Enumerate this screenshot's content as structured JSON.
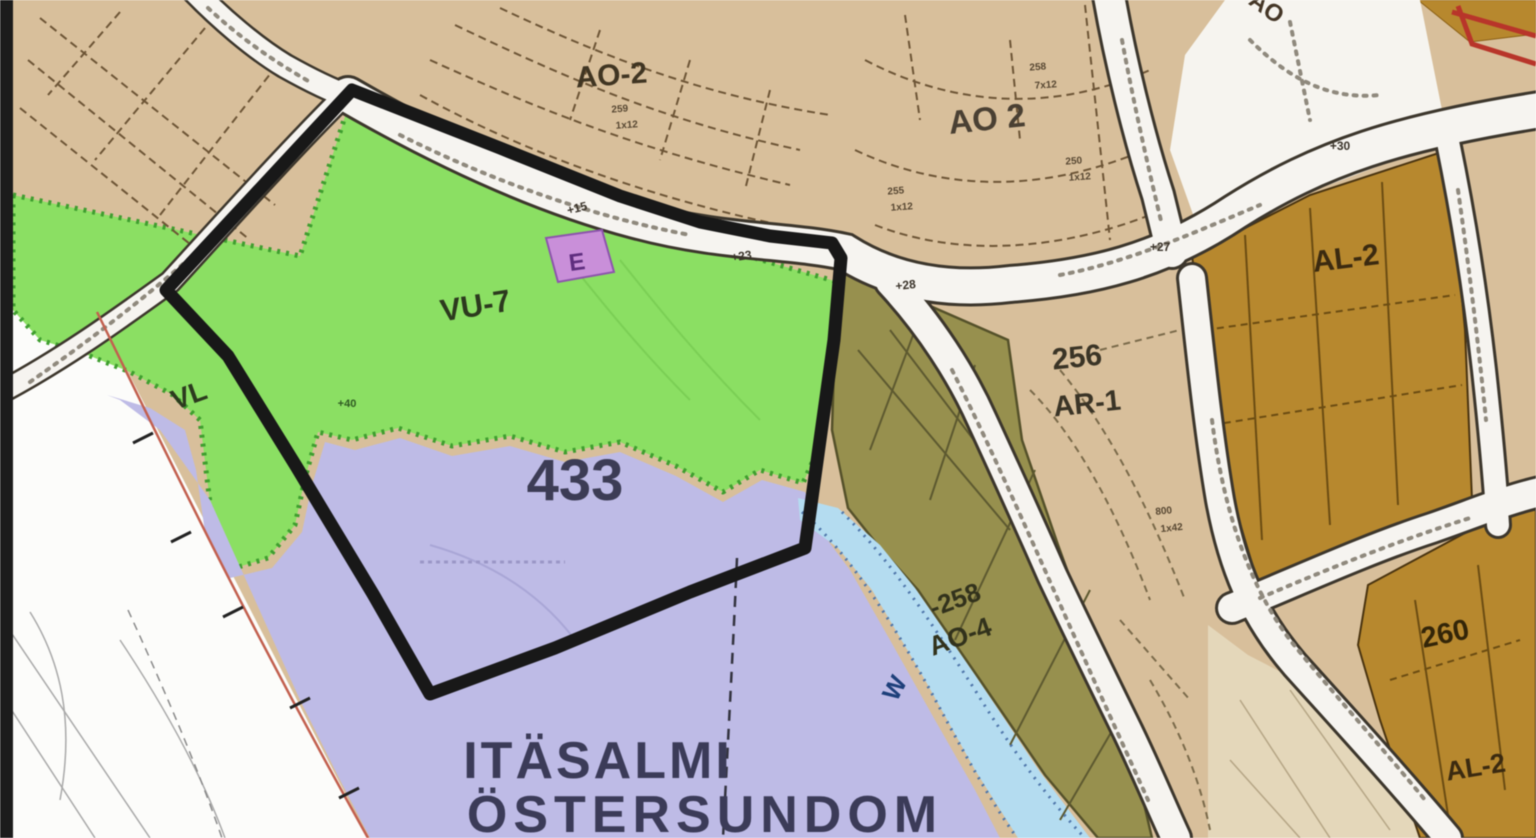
{
  "map": {
    "description_labels": {
      "ao2_west": "AO-2",
      "ao2_east": "AO 2",
      "vu7": "VU-7",
      "vl": "VL",
      "district_number": "433",
      "b256": "256",
      "ar1": "AR-1",
      "b258": "-258",
      "ao4": "AO-4",
      "al2_north": "AL-2",
      "b260": "260",
      "al2_south": "AL-2",
      "water": "W",
      "et": "E",
      "ao_partial": "AO"
    },
    "place": {
      "line1": "ITÄSALMI",
      "line2": "ÖSTERSUNDOM"
    },
    "elevations": [
      "+15",
      "+23",
      "+28",
      "+27",
      "+30",
      "+40"
    ],
    "parcel_codes": [
      "258",
      "7x12",
      "250",
      "1x12",
      "255",
      "1x12",
      "800",
      "1x42",
      "259",
      "1x12"
    ],
    "colors": {
      "residential_tan": "#d8bf9b",
      "park_green": "#8bdf63",
      "district_purple": "#bebbe6",
      "water_blue": "#b4dcf0",
      "olive_block": "#97904e",
      "commercial_brown": "#b7882e",
      "pale_block": "#e4d7ba",
      "road_white": "#f6f4f0",
      "boundary_black": "#181818",
      "plan_edge_red": "#c2604f",
      "place_text": "#3b3b58"
    }
  }
}
